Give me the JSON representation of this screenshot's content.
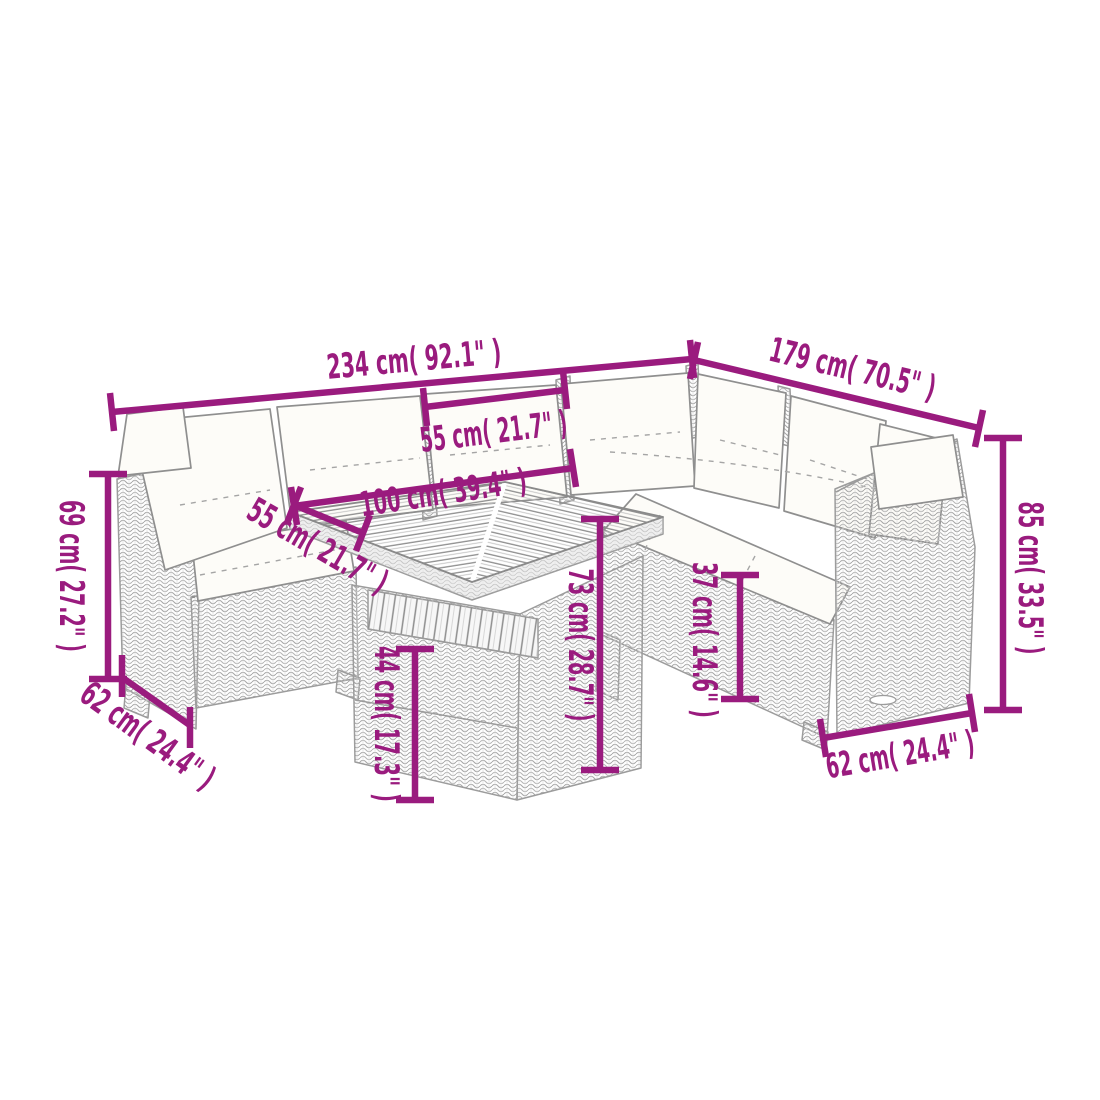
{
  "diagram": {
    "subject": "L-shaped poly rattan garden lounge set with slatted table",
    "accent_color": "#9A1B7E",
    "sketch_color": "#9c9c9c",
    "background_color": "#ffffff"
  },
  "dimensions": [
    {
      "id": "total-width",
      "label": "234 cm( 92.1\" )"
    },
    {
      "id": "right-side-depth",
      "label": "179 cm( 70.5\" )"
    },
    {
      "id": "seat-width",
      "label": "55 cm( 21.7\" )"
    },
    {
      "id": "table-top-length",
      "label": "100 cm( 39.4\" )"
    },
    {
      "id": "seat-depth",
      "label": "55 cm( 21.7\" )"
    },
    {
      "id": "armrest-height",
      "label": "69 cm( 27.2\" )"
    },
    {
      "id": "armrest-depth-left",
      "label": "62 cm( 24.4\" )"
    },
    {
      "id": "table-shelf-height",
      "label": "44 cm( 17.3\" )"
    },
    {
      "id": "table-height",
      "label": "73 cm( 28.7\" )"
    },
    {
      "id": "sofa-base-height",
      "label": "37 cm( 14.6\" )"
    },
    {
      "id": "back-height",
      "label": "85 cm( 33.5\" )"
    },
    {
      "id": "armrest-depth-right",
      "label": "62 cm( 24.4\" )"
    }
  ]
}
